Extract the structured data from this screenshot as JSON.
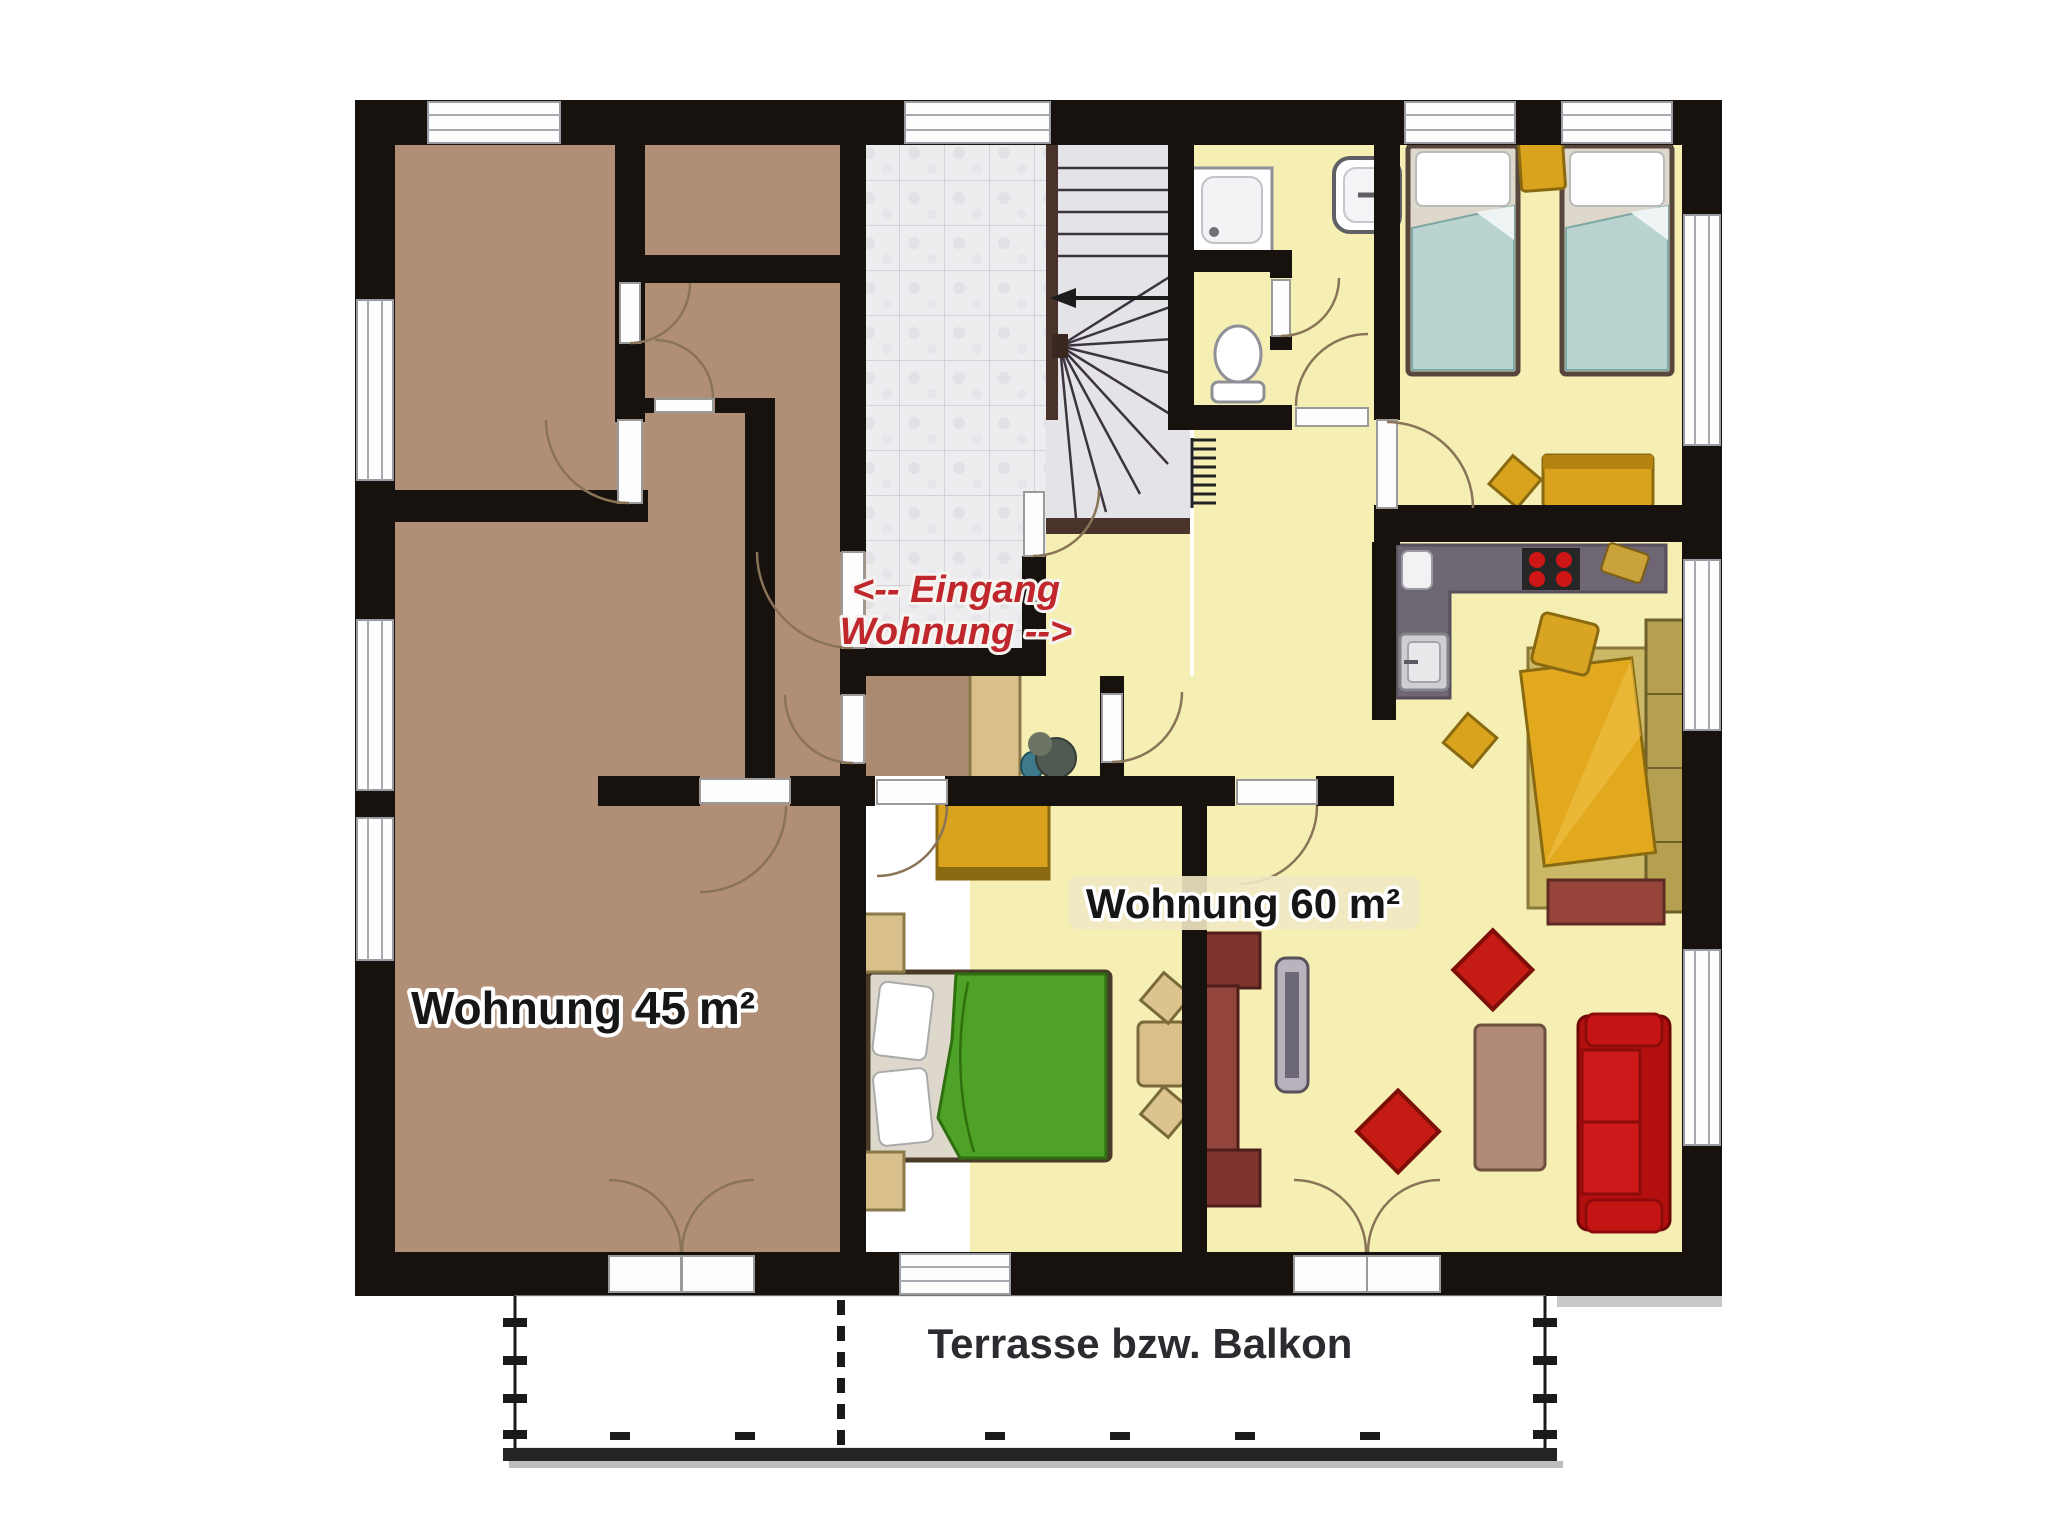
{
  "labels": {
    "apartment_left": "Wohnung 45 m²",
    "apartment_right": "Wohnung 60 m²",
    "entrance_line1": "<-- Eingang",
    "entrance_line2": "Wohnung -->",
    "terrace": "Terrasse bzw. Balkon"
  },
  "palette": {
    "wall": "#17120e",
    "floor_left_apartment": "#b18f76",
    "floor_right_apartment": "#f5efb4",
    "floor_entrance_tiles": "#ededef",
    "floor_stairs": "#e4e3e8",
    "entrance_text_red": "#c0272d",
    "label_black": "#161616",
    "terrace_text": "#2c2c30",
    "kitchen_counter": "#6e6672",
    "furniture_gold": "#d9a31d",
    "furniture_tan": "#d9c08a",
    "sofa_red": "#c41414",
    "sideboard_maroon": "#8e3b36",
    "bed_blanket_blue": "#b9d3d0",
    "bed_blanket_green": "#4ea227",
    "stove_burner_red": "#cf1616"
  },
  "rooms": {
    "left_apartment": [
      "top-left-room",
      "closet",
      "middle-room",
      "corridor",
      "living-room-45"
    ],
    "right_apartment": [
      "entrance-hall-tiled",
      "stairwell",
      "vestibule",
      "entry-hall",
      "bathroom-shower",
      "wc",
      "bedroom-north",
      "kitchen",
      "bedroom-middle",
      "living-room-60"
    ],
    "outdoor": [
      "terrace"
    ]
  },
  "fixtures": [
    "shower",
    "toilet",
    "sink",
    "kitchen-sink",
    "stove",
    "appliance",
    "radiator"
  ],
  "furniture": [
    "single-bed-1",
    "single-bed-2",
    "nightstand",
    "stool",
    "dresser",
    "wardrobe",
    "double-bed-green",
    "dining-table",
    "dining-chairs",
    "sideboard",
    "tv",
    "red-armchair-1",
    "red-armchair-2",
    "coffee-table",
    "red-sofa",
    "yellow-daybed",
    "ottoman",
    "plant",
    "hall-wardrobe"
  ]
}
